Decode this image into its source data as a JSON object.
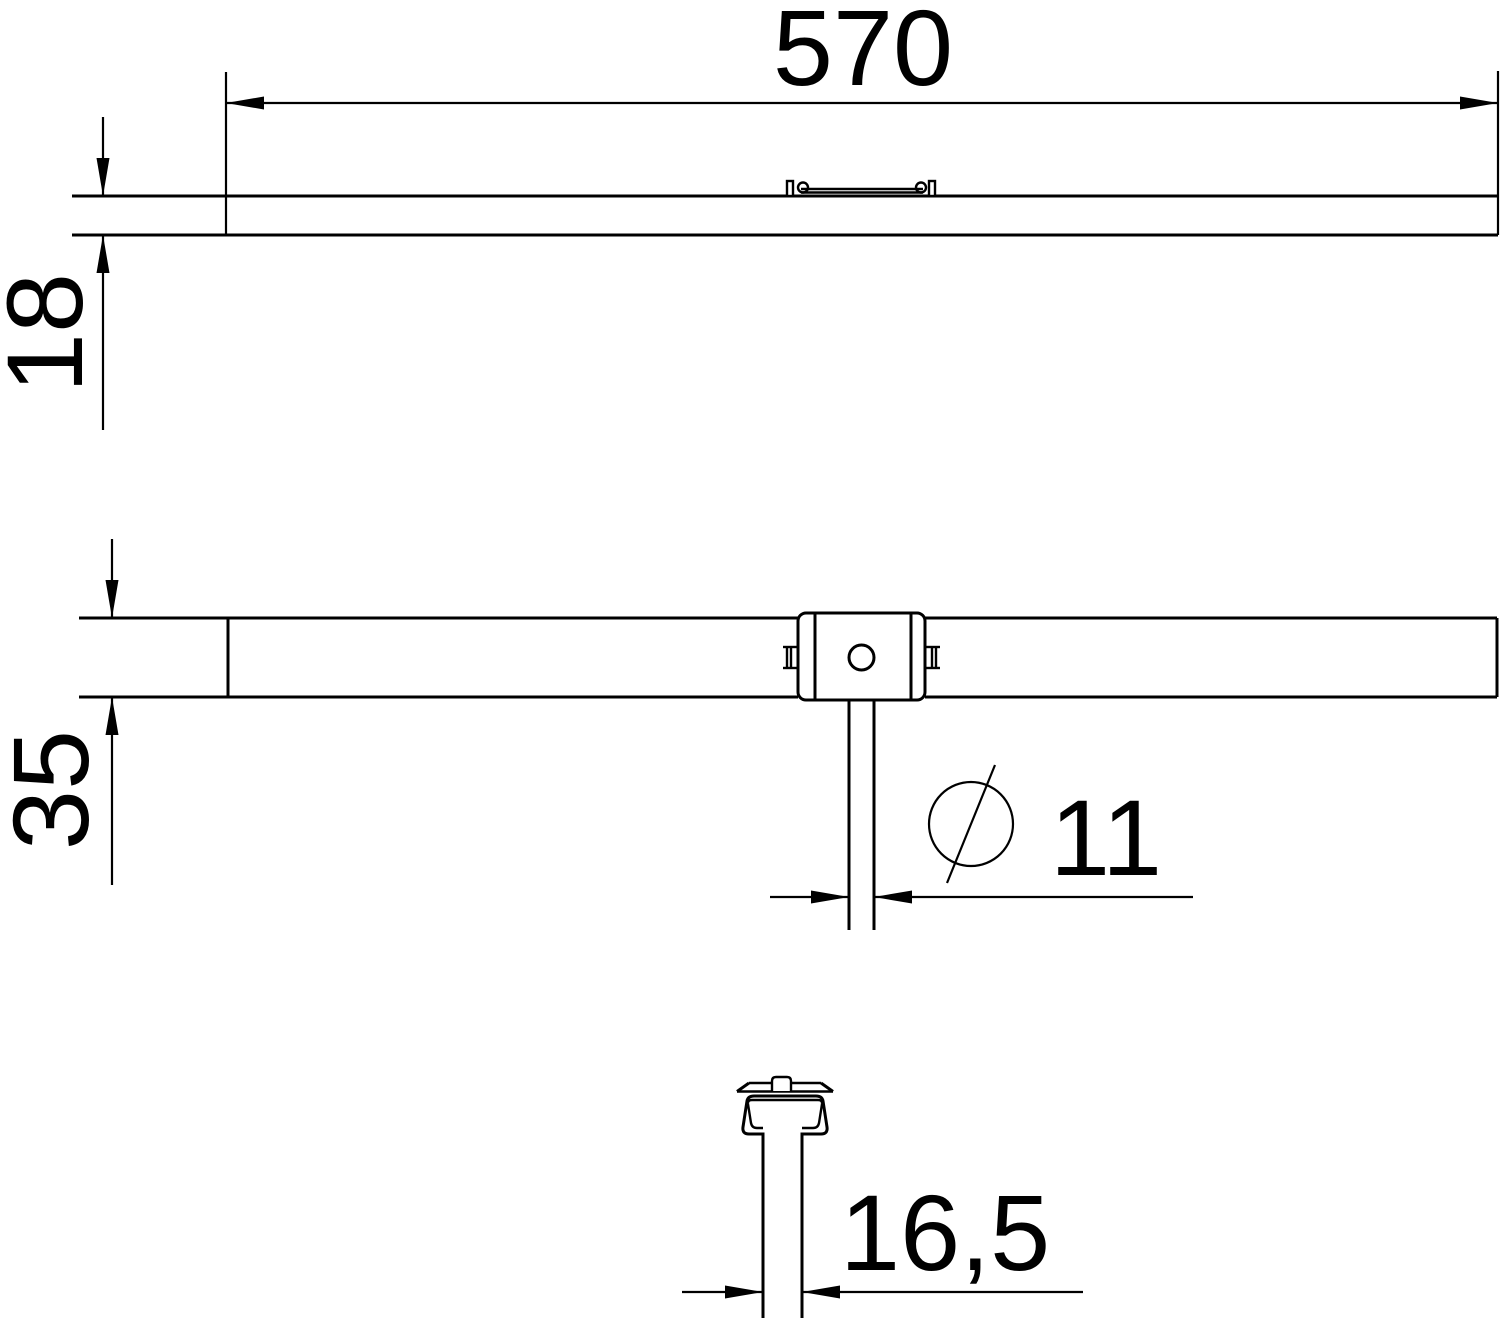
{
  "drawing": {
    "kind": "technical-dimension-drawing",
    "colors": {
      "line": "#000000",
      "background": "#ffffff"
    },
    "dimensions": {
      "length": "570",
      "rail_height": "18",
      "rail_width": "35",
      "rod_diameter": "11",
      "rod_diameter_symbol": "⌀",
      "stem_width": "16,5"
    },
    "views": {
      "side_view": "side view of rail (length 570, height 18)",
      "plan_view": "plan view of rail (width 35) with suspension block and rod ⌀11",
      "section_view": "cross-section of profile stem (width 16,5)"
    }
  }
}
